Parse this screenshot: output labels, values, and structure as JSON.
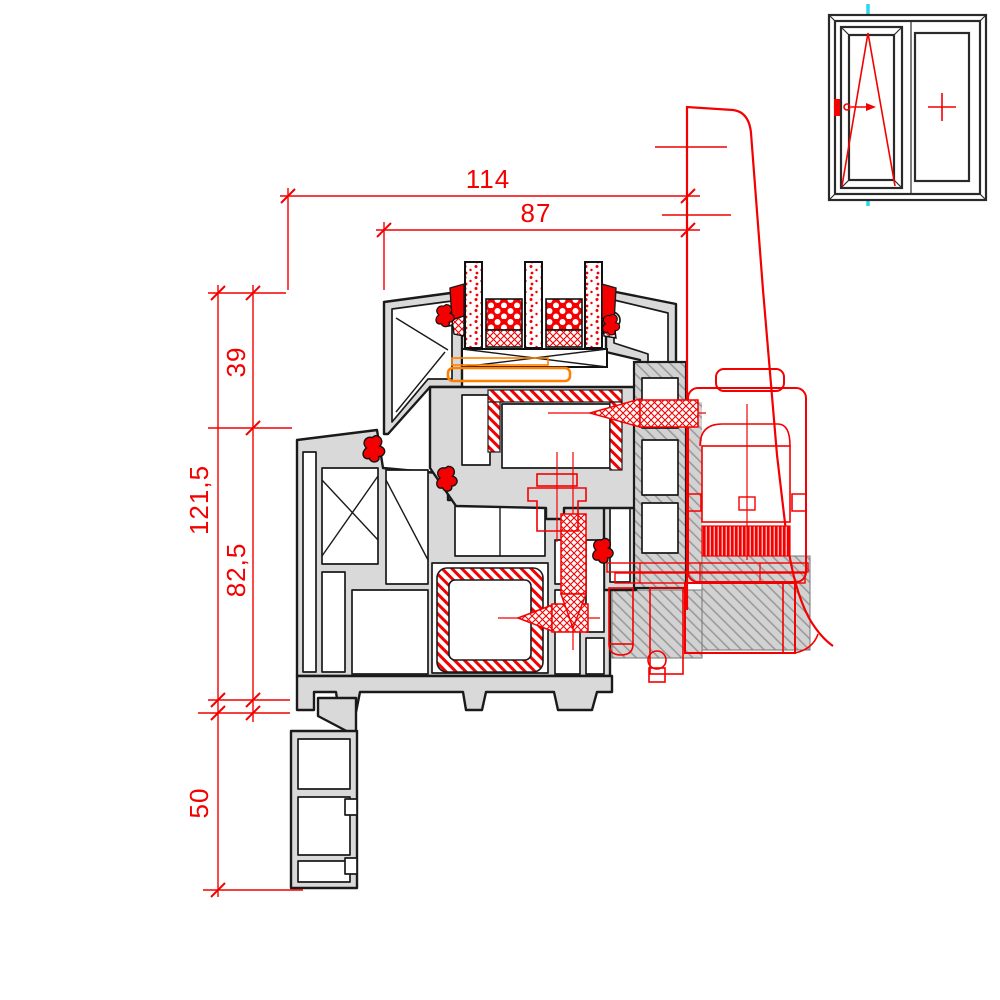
{
  "drawing": {
    "dimensions": {
      "d114": "114",
      "d87": "87",
      "d39": "39",
      "d121_5": "121,5",
      "d82_5": "82,5",
      "d50": "50"
    },
    "icons": {
      "window_type_icon": "tilt-turn-window-elevation",
      "left_pane_symbol": "tilt-turn-triangle",
      "right_pane_symbol": "fixed-pane-cross",
      "section_line_icon": "vertical-section-cut-line",
      "handle_icon": "window-handle",
      "screw_icons": "fixing-screws",
      "gasket_icons": "rubber-gaskets"
    },
    "colors": {
      "dimension_red": "#f40000",
      "detail_red": "#f40000",
      "section_cyan": "#2bd8ea",
      "profile_fill": "#d9d9d9",
      "profile_outline": "#1a1a1a",
      "hatch_gray": "#9a9a9a",
      "bracket_orange": "#ff7f00",
      "background": "#ffffff"
    }
  }
}
